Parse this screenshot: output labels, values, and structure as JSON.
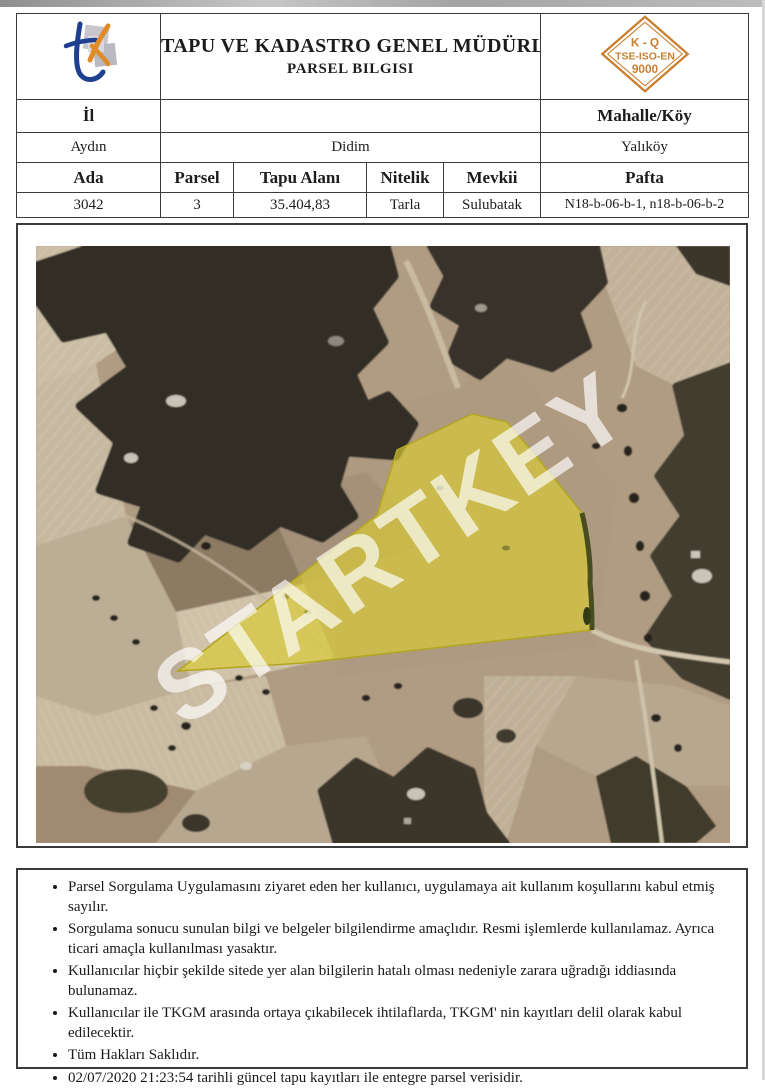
{
  "header": {
    "title_line1": "TAPU VE KADASTRO GENEL MÜDÜRLÜĞÜ",
    "title_line2": "PARSEL BILGISI",
    "badge": {
      "line1": "K - Q",
      "line2": "TSE-ISO-EN",
      "line3": "9000",
      "color": "#c97f2e"
    }
  },
  "location": {
    "col1_header": "İl",
    "col3_header": "Mahalle/Köy",
    "il": "Aydın",
    "ilce": "Didim",
    "mahalle_koy": "Yalıköy"
  },
  "parcel": {
    "headers": [
      "Ada",
      "Parsel",
      "Tapu Alanı",
      "Nitelik",
      "Mevkii",
      "Pafta"
    ],
    "values": [
      "3042",
      "3",
      "35.404,83",
      "Tarla",
      "Sulubatak",
      "N18-b-06-b-1, n18-b-06-b-2"
    ]
  },
  "map": {
    "watermark": "STARTKEY",
    "parcel_highlight_color": "#d8ca35"
  },
  "footer": {
    "bullets": [
      "Parsel Sorgulama Uygulamasını ziyaret eden her kullanıcı, uygulamaya ait kullanım koşullarını kabul etmiş sayılır.",
      "Sorgulama sonucu sunulan bilgi ve belgeler bilgilendirme amaçlıdır. Resmi işlemlerde kullanılamaz. Ayrıca ticari amaçla kullanılması yasaktır.",
      "Kullanıcılar hiçbir şekilde sitede yer alan bilgilerin hatalı olması nedeniyle zarara uğradığı iddiasında bulunamaz.",
      "Kullanıcılar ile TKGM arasında ortaya çıkabilecek ihtilaflarda, TKGM' nin kayıtları delil olarak kabul edilecektir.",
      "Tüm Hakları Saklıdır.",
      "02/07/2020 21:23:54 tarihli güncel tapu kayıtları ile entegre parsel verisidir."
    ]
  }
}
